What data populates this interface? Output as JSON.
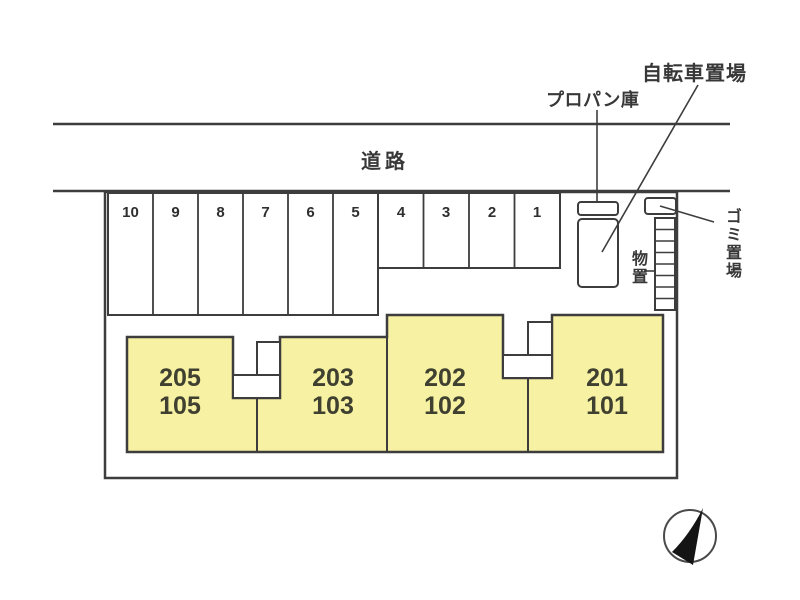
{
  "plan": {
    "road_label": "道路",
    "propane_label": "プロパン庫",
    "bicycle_label": "自転車置場",
    "garbage_label": "ゴミ置場",
    "storage_label": "物置",
    "parking_row_deep": [
      "10",
      "9",
      "8",
      "7",
      "6",
      "5"
    ],
    "parking_row_shallow": [
      "4",
      "3",
      "2",
      "1"
    ],
    "units": [
      {
        "upper": "205",
        "lower": "105"
      },
      {
        "upper": "203",
        "lower": "103"
      },
      {
        "upper": "202",
        "lower": "102"
      },
      {
        "upper": "201",
        "lower": "101"
      }
    ],
    "colors": {
      "building_fill": "#f6f1a3",
      "line": "#3d3d3d",
      "unit_text": "#3f4030",
      "label_text": "#383838"
    }
  }
}
